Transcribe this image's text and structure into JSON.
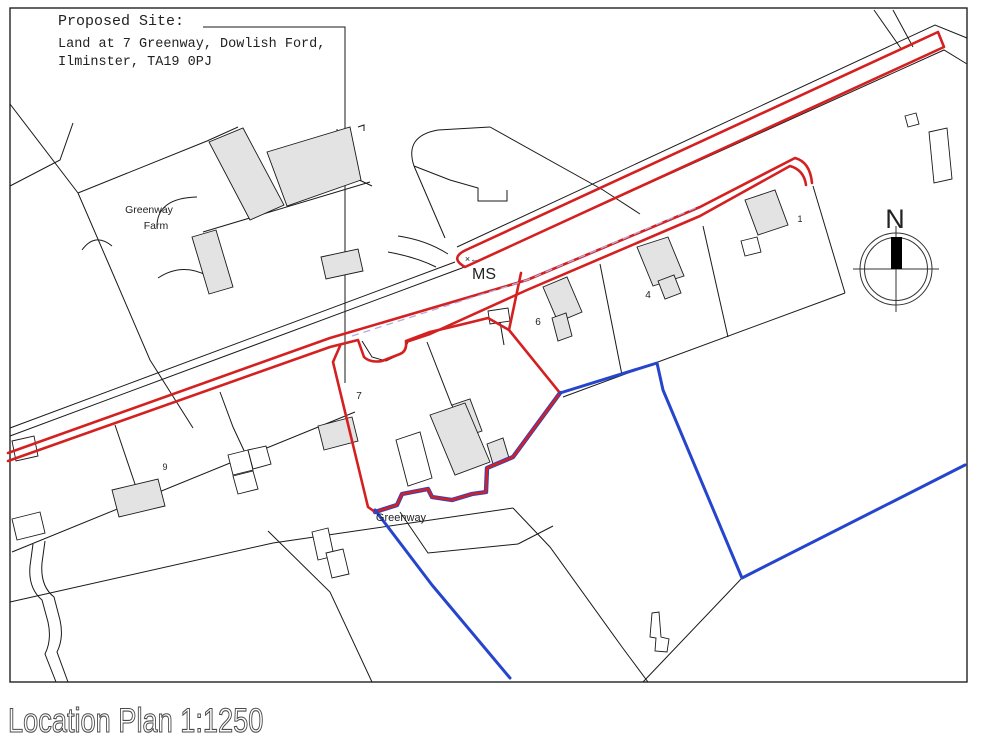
{
  "title_block": {
    "line1": "Proposed Site:",
    "line2": "Land at 7 Greenway, Dowlish Ford,",
    "line3": "Ilminster, TA19 0PJ"
  },
  "caption": "Location Plan 1:1250",
  "compass": {
    "north_label": "N"
  },
  "labels": {
    "farm_name_line1": "Greenway",
    "farm_name_line2": "Farm",
    "road_marker": "MS",
    "benchmark_marker": "×←",
    "street_name": "Greenway",
    "plot_1": "1",
    "plot_4": "4",
    "plot_6": "6",
    "plot_7": "7",
    "plot_9": "9"
  },
  "colors": {
    "site_boundary_red": "#d42020",
    "other_boundary_blue": "#2545cc",
    "building_fill_gray": "#e3e3e3",
    "parcel_line_black": "#1a1a1a",
    "track_dash_lavender": "#b5abe0"
  }
}
